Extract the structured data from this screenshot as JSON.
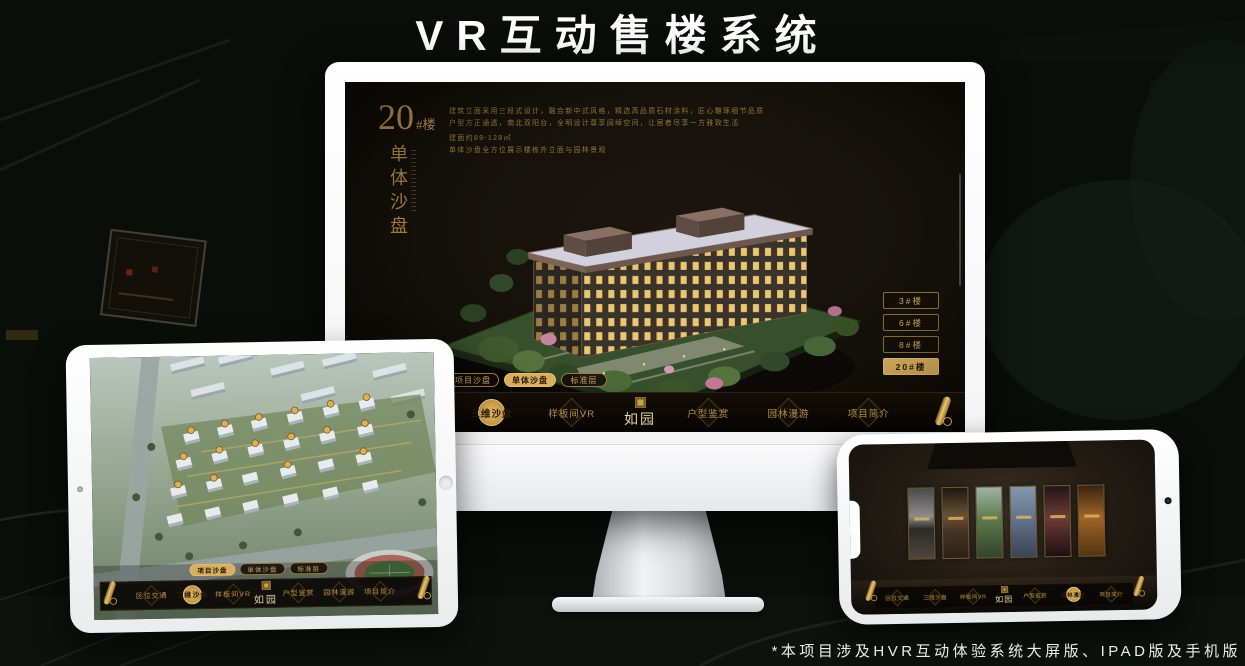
{
  "page": {
    "title": "VR互动售楼系统",
    "footnote": "*本项目涉及HVR互动体验系统大屏版、IPAD版及手机版"
  },
  "brand": {
    "logo_text": "如园"
  },
  "colors": {
    "gold": "#c9a45c",
    "gold_active": "#d9ae5e",
    "screen_bg": "#14100a"
  },
  "nav_items": [
    "区位交通",
    "三维沙盘",
    "样板间VR",
    "户型鉴赏",
    "园林漫游",
    "项目简介"
  ],
  "sub_tabs": [
    "项目沙盘",
    "单体沙盘",
    "标准层"
  ],
  "monitor": {
    "building_no": "20",
    "building_no_suffix": "#楼",
    "screen_title_vertical": "单体沙盘",
    "active_sub_tab": "单体沙盘",
    "active_nav": "三维沙盘",
    "floor_buttons": [
      "3#楼",
      "6#楼",
      "8#楼",
      "20#楼"
    ],
    "active_floor": "20#楼",
    "description_lines": [
      "建筑立面采用三段式设计，融合新中式风格，精选高品质石材涂料，匠心雕琢细节品质",
      "户型方正通透，南北双阳台，全明设计尊享阔绰空间，让居者尽享一方雅致生活",
      "建面约89-128㎡",
      "单体沙盘全方位展示楼栋外立面与园林景观"
    ]
  },
  "ipad": {
    "active_sub_tab": "项目沙盘",
    "active_nav": "三维沙盘"
  },
  "phone": {
    "active_nav": "园林漫游"
  }
}
